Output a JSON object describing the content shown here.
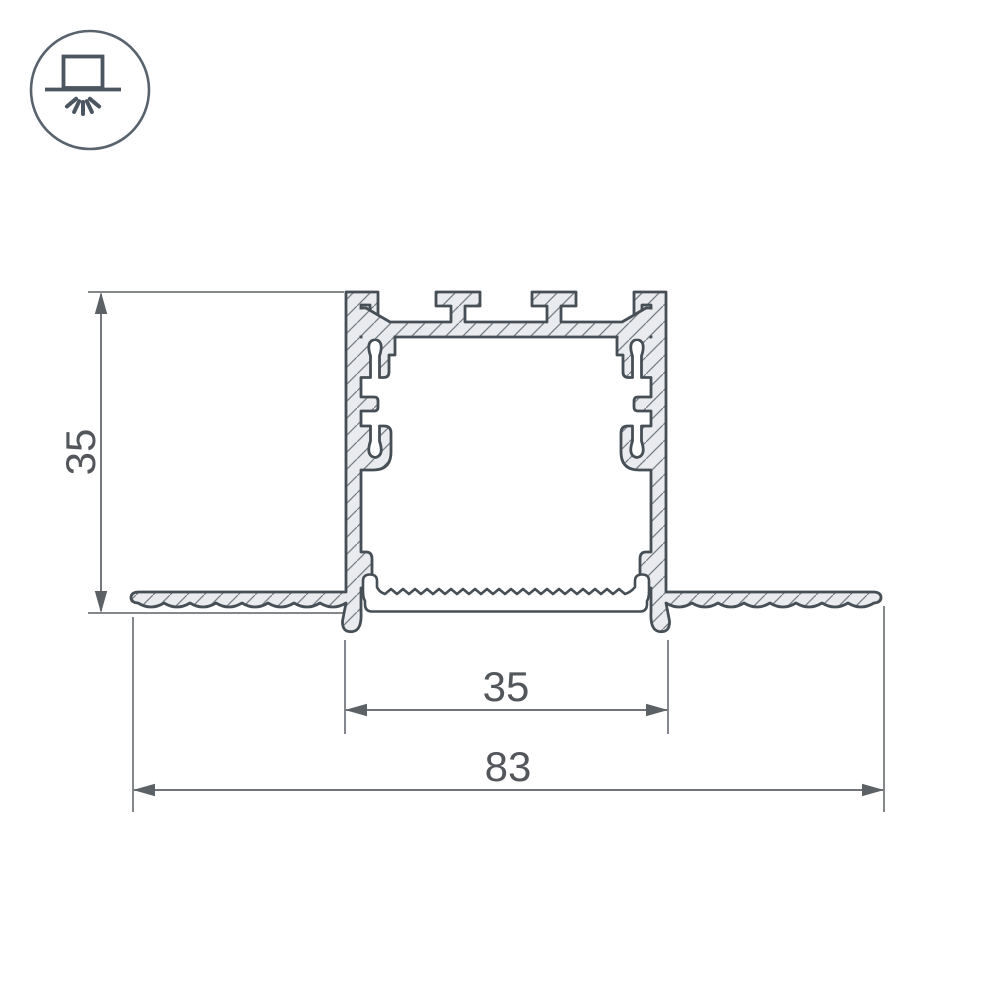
{
  "drawing": {
    "title": "recessed-led-profile-cross-section",
    "dimensions": {
      "height": "35",
      "inner_width": "35",
      "overall_width": "83"
    },
    "icon": {
      "name": "recessed-downlight-icon",
      "description": "recessed luminaire symbol: lamp box on ceiling line with light rays below"
    },
    "colors": {
      "outline": "#474f56",
      "hatch_fill": "#e9ebee",
      "hatch_line": "#767e85",
      "dimension": "#5b6165",
      "text": "#53575b",
      "icon": "#4b5660",
      "background": "#ffffff"
    }
  }
}
